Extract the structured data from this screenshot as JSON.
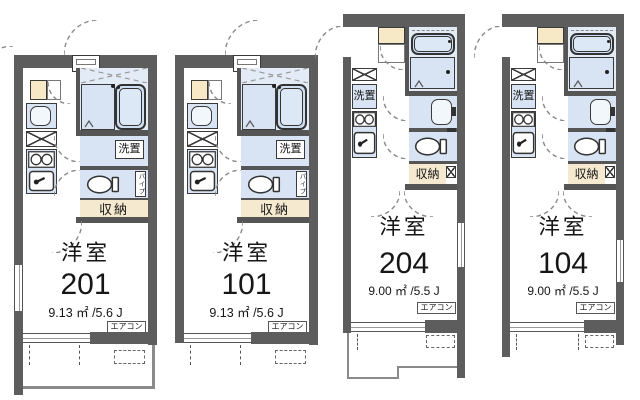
{
  "plan": {
    "units": [
      {
        "name": "洋室",
        "number": "201",
        "area": "9.13 ㎡ /5.6 J",
        "closet": "収納",
        "laundry": "洗置",
        "aircon": "エアコン",
        "pipe": "パイプ"
      },
      {
        "name": "洋室",
        "number": "101",
        "area": "9.13 ㎡ /5.6 J",
        "closet": "収納",
        "laundry": "洗置",
        "aircon": "エアコン",
        "pipe": "パイプ"
      },
      {
        "name": "洋室",
        "number": "204",
        "area": "9.00 ㎡ /5.5 J",
        "closet": "収納",
        "laundry": "洗置",
        "aircon": "エアコン"
      },
      {
        "name": "洋室",
        "number": "104",
        "area": "9.00 ㎡ /5.5 J",
        "closet": "収納",
        "laundry": "洗置",
        "aircon": "エアコン"
      }
    ],
    "colors": {
      "wall": "#5d5d5d",
      "fixture_fill": "#d8e4f3",
      "bath_fill": "#e3ebf6",
      "closet_fill": "#f5ead0",
      "shelf_fill": "#f8e9c6",
      "line": "#3a3a3a"
    }
  }
}
